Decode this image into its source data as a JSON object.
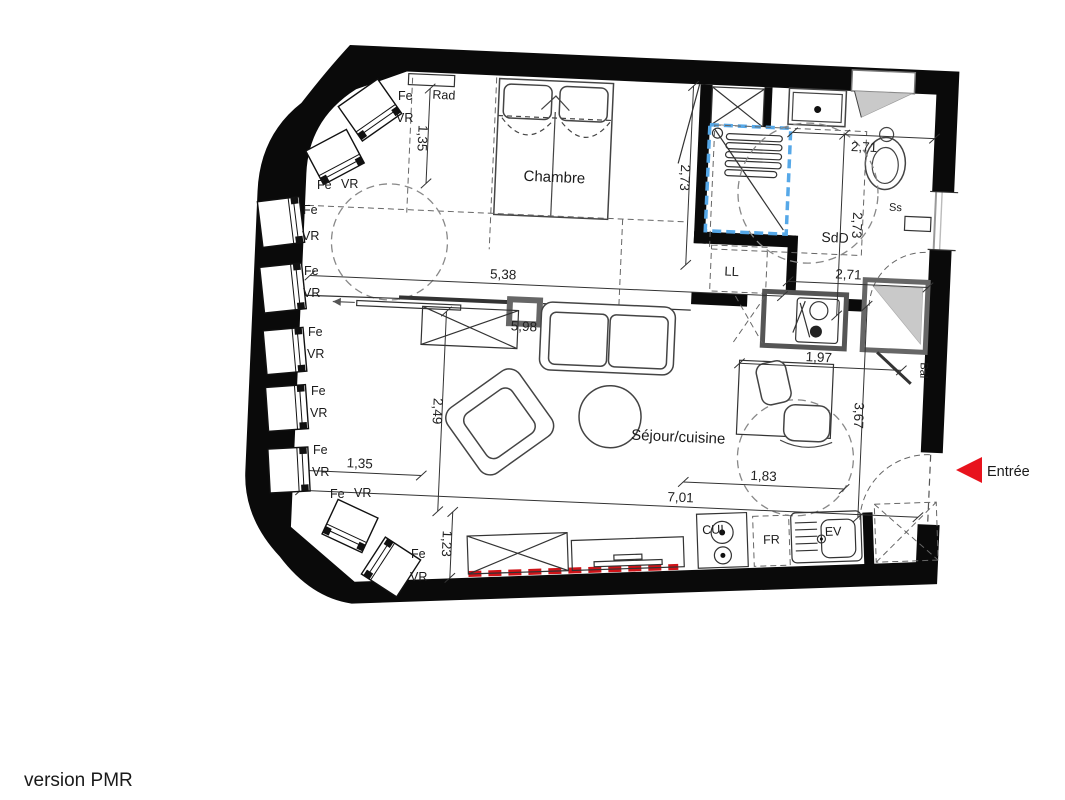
{
  "plan": {
    "rooms": {
      "bedroom": "Chambre",
      "living": "Séjour/cuisine",
      "shower_room": "SdD"
    },
    "entry": {
      "label": "Entrée"
    },
    "equipment": {
      "radiator": "Rad",
      "washing_machine": "LL",
      "towel_dryer": "Ss",
      "balcony": "Bal",
      "cooktop": "CUI",
      "fridge": "FR",
      "sink": "EV"
    },
    "win": {
      "fe": "Fe",
      "vr": "VR"
    },
    "dims": {
      "bedroom_left": "1,35",
      "bedroom_right": "2,73",
      "bedroom_width": "5,38",
      "shower_top": "2,71",
      "shower_height": "2,73",
      "hall_width": "2,71",
      "sliding_door": "5,98",
      "living_height": "2,49",
      "desk_width": "1,97",
      "entry_height": "3,67",
      "living_left": "1,35",
      "entry_width": "1,83",
      "living_width": "7,01",
      "kitchen_depth": "1,23"
    },
    "colors": {
      "wall": "#0a0a0a",
      "shower_outline": "#56a8e8",
      "entry_arrow": "#e8131d",
      "floor_marker": "#cf1318"
    }
  },
  "footer": {
    "caption": "version PMR"
  }
}
